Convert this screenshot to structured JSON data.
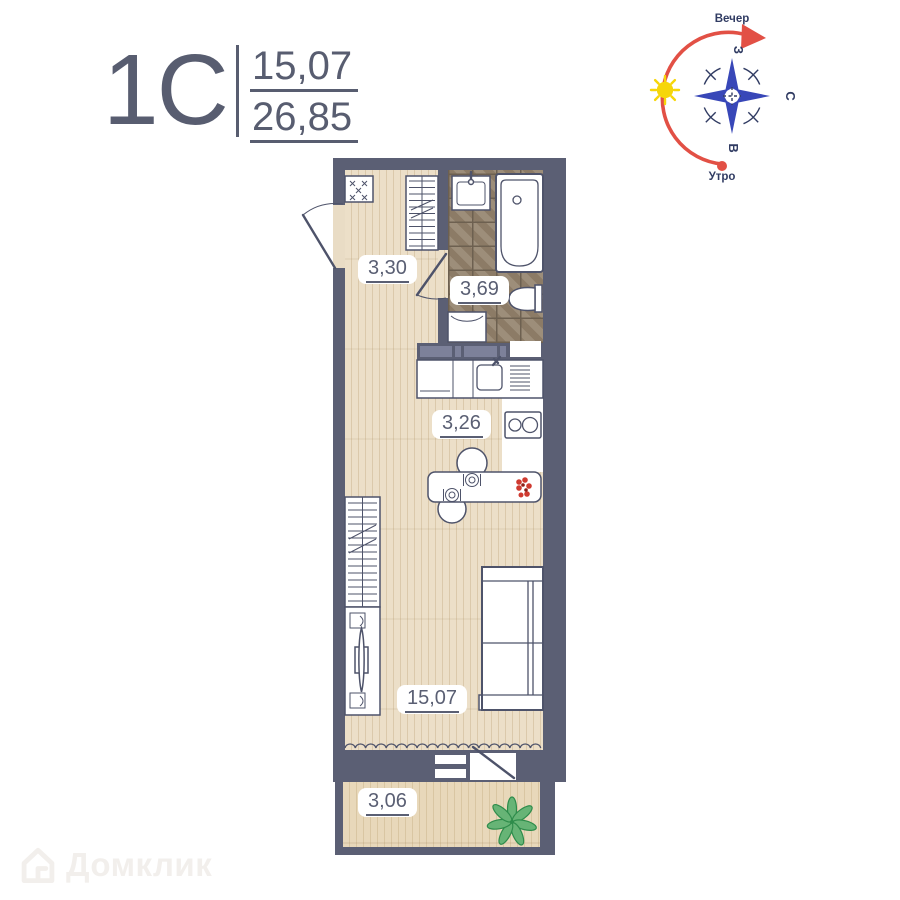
{
  "header": {
    "plan_type": "1С",
    "living_area": "15,07",
    "total_area": "26,85"
  },
  "compass": {
    "evening": "Вечер",
    "morning": "Утро",
    "west": "З",
    "north": "С",
    "east": "В"
  },
  "rooms": {
    "hall": {
      "label": "3,30"
    },
    "bathroom": {
      "label": "3,69"
    },
    "kitchen": {
      "label": "3,26"
    },
    "living": {
      "label": "15,07"
    },
    "balcony": {
      "label": "3,06"
    }
  },
  "watermark": {
    "brand": "Домклик"
  },
  "icons": {
    "sun": "radial-rays",
    "compass-rose": "four-blue-arrows",
    "plant": "leaf-rosette",
    "flower": "red-cluster",
    "domklik-logo": "house-outline"
  },
  "colors": {
    "wall": "#5b5f74",
    "wood": "#ecdfc8",
    "wood_line": "#dbc9ab",
    "tile": "#95846f",
    "tile_line": "#6d6050",
    "fixture": "#4e536a",
    "ink": "#585d70",
    "accent_red": "#e25045",
    "compass_blue": "#3847b8",
    "compass_navy": "#313c63",
    "sun_yellow": "#f6d60a",
    "plant_green": "#67b476",
    "plant_dark": "#2e8c4b",
    "flower_red": "#cf3a30",
    "label": "#5a5f73",
    "duct": "#7d819a",
    "watermark": "#f2efec"
  }
}
